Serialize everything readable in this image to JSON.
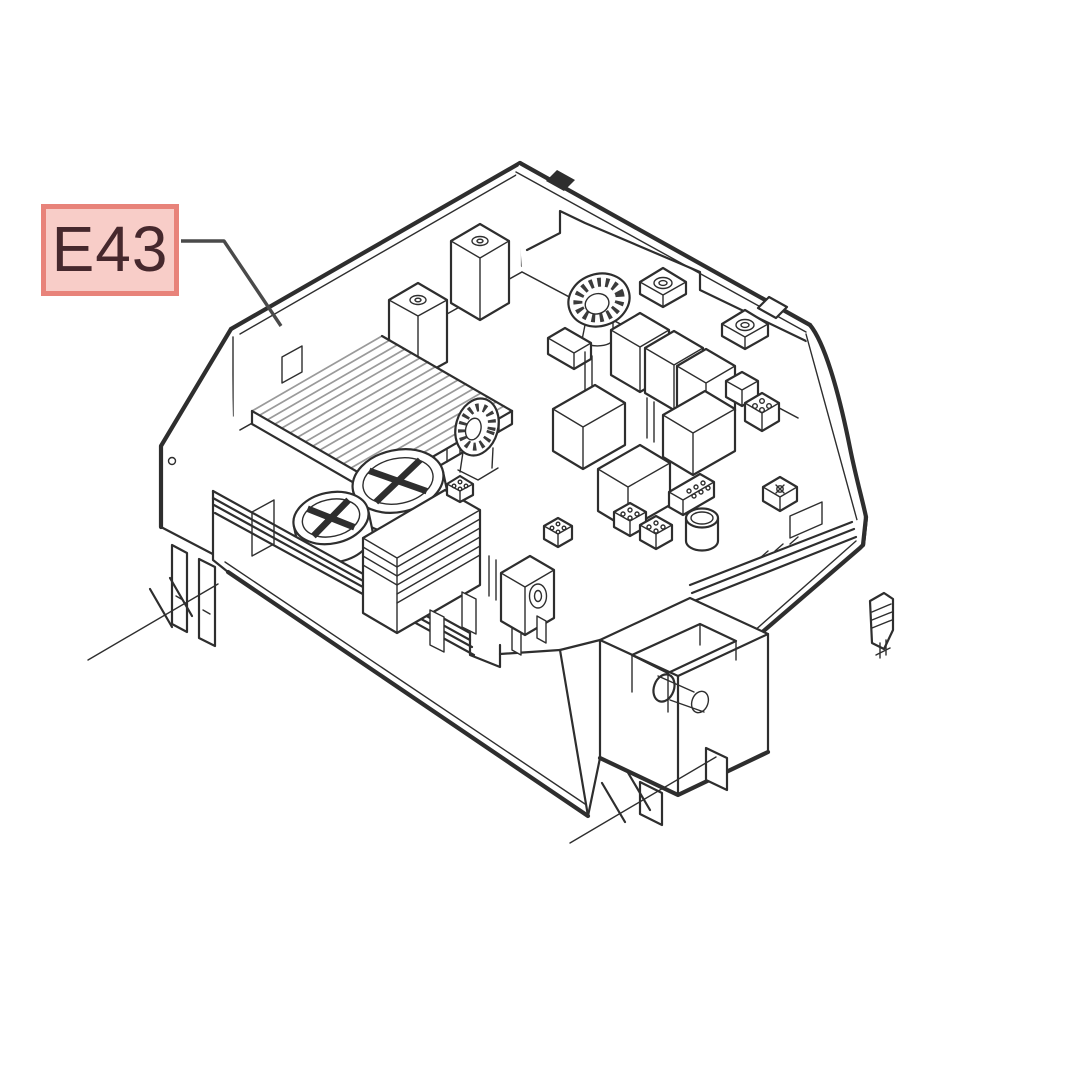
{
  "callout": {
    "label": "E43"
  },
  "colors": {
    "page-bg": "#ffffff",
    "callout-fill": "#f8cdc8",
    "callout-border": "#e8837a",
    "callout-text": "#46282d",
    "line": "#2e2e2e",
    "line-soft": "#4a4a4a",
    "fin": "#9a9a9a"
  }
}
